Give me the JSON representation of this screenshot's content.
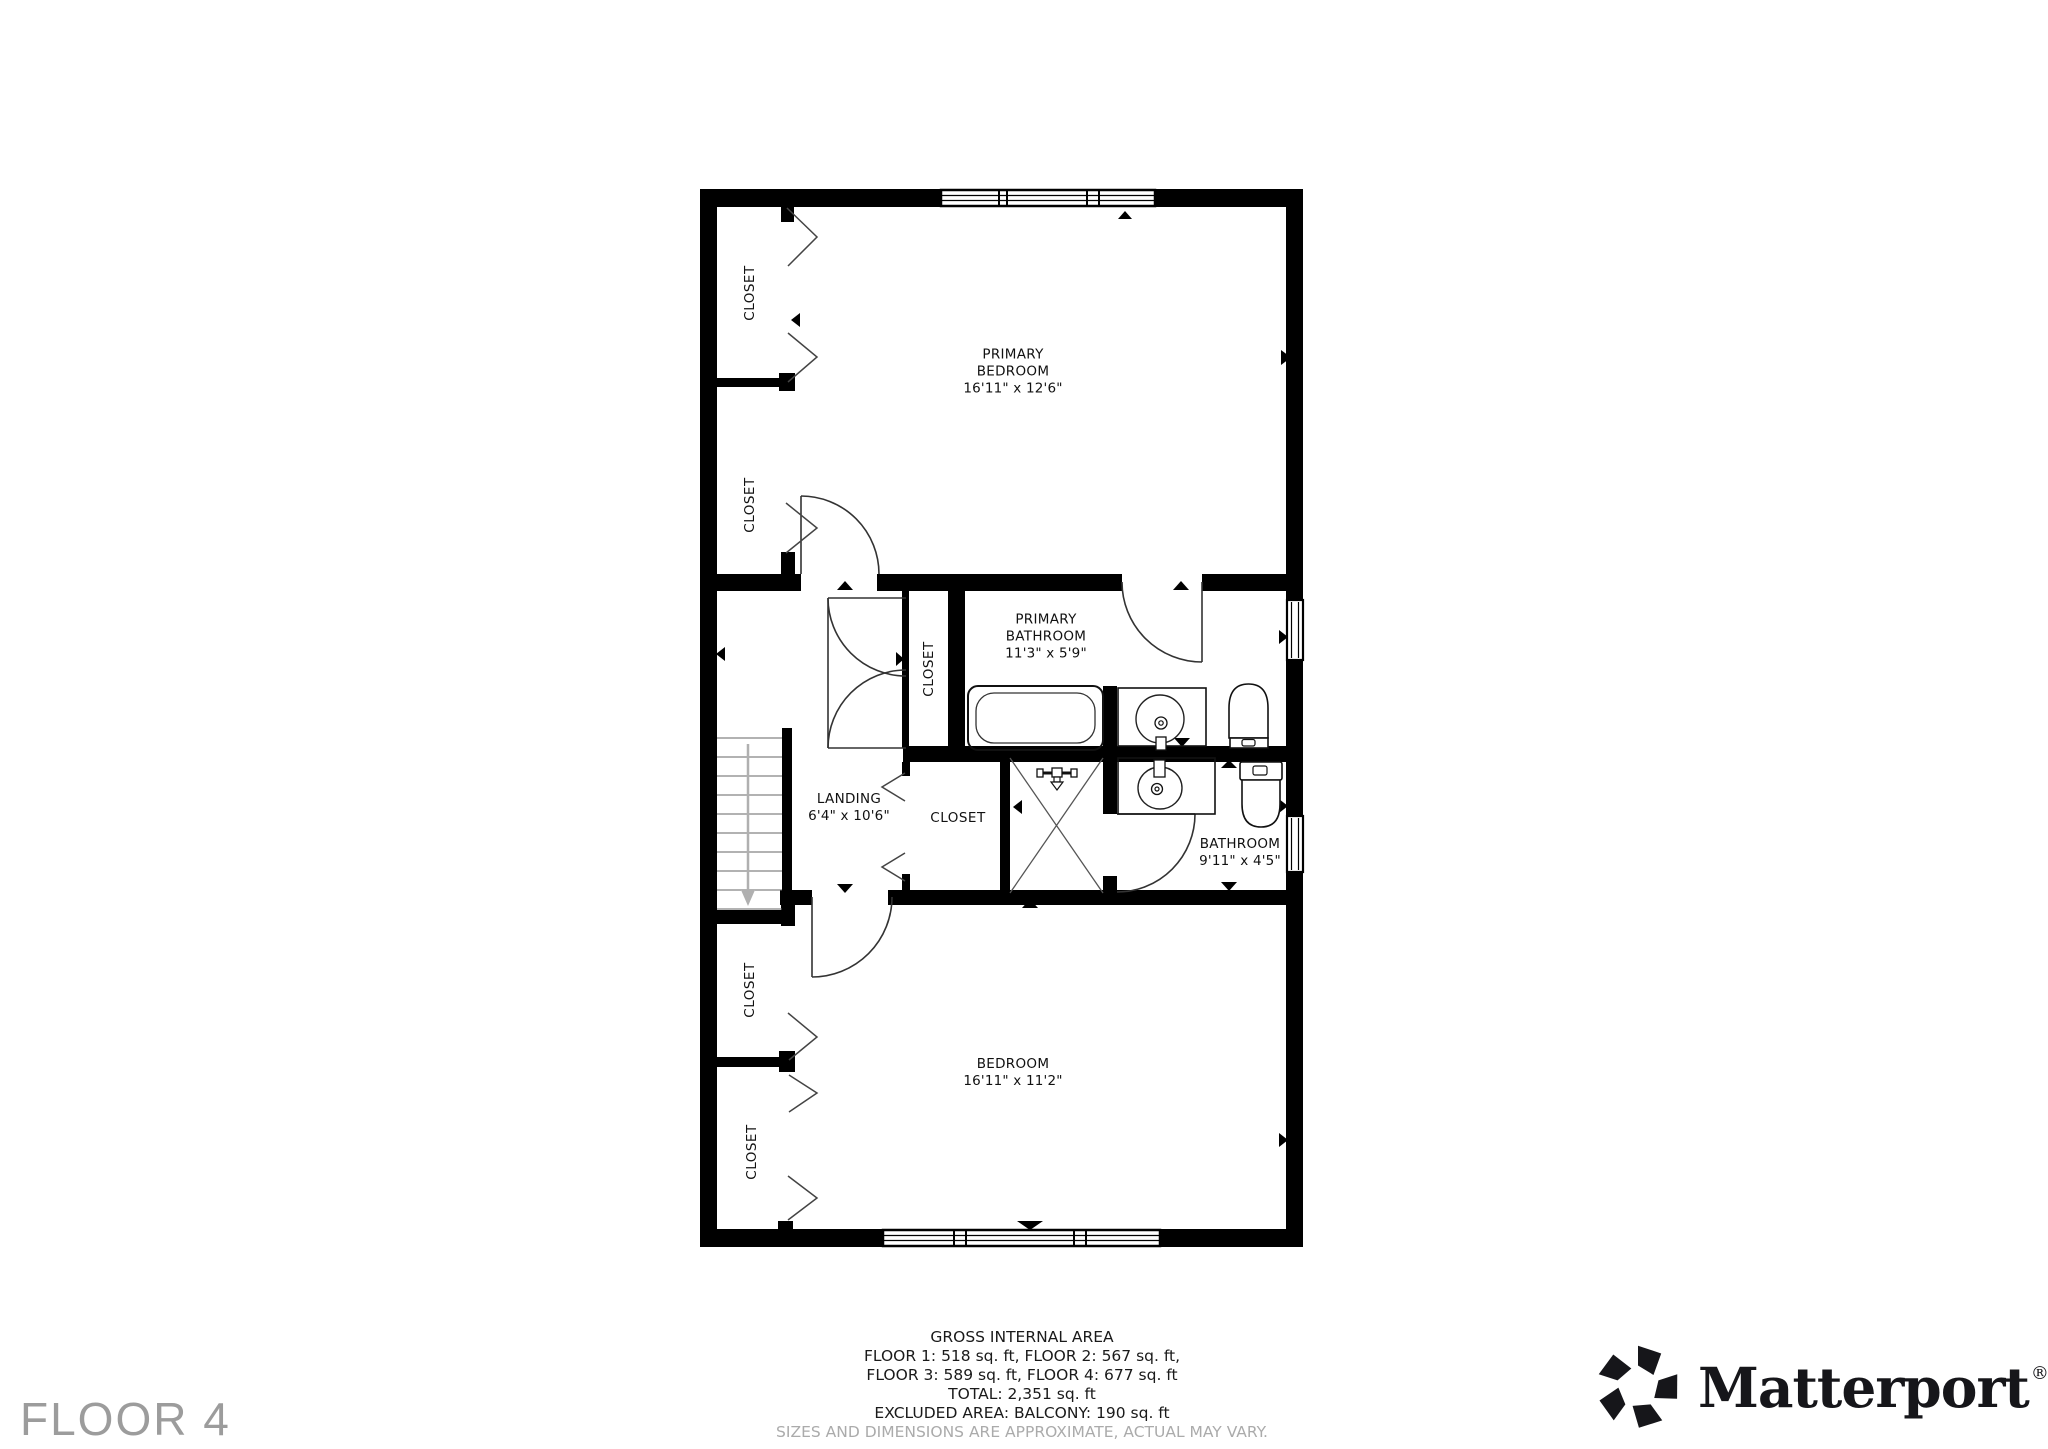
{
  "floor_label": "FLOOR 4",
  "closet_label": "CLOSET",
  "rooms": [
    {
      "line1": "PRIMARY",
      "line2": "BEDROOM",
      "dims": "16'11\" x 12'6\""
    },
    {
      "line1": "PRIMARY",
      "line2": "BATHROOM",
      "dims": "11'3\" x 5'9\""
    },
    {
      "line1": "LANDING",
      "dims": "6'4\" x 10'6\""
    },
    {
      "line1": "BATHROOM",
      "dims": "9'11\" x 4'5\""
    },
    {
      "line1": "BEDROOM",
      "dims": "16'11\" x 11'2\""
    }
  ],
  "area_summary": {
    "title": "GROSS INTERNAL AREA",
    "line_floors_1_2": "FLOOR 1: 518 sq. ft, FLOOR 2: 567 sq. ft,",
    "line_floors_3_4": "FLOOR 3: 589 sq. ft, FLOOR 4: 677 sq. ft",
    "total": "TOTAL: 2,351 sq. ft",
    "excluded": "EXCLUDED AREA: BALCONY: 190 sq. ft",
    "disclaimer": "SIZES AND DIMENSIONS ARE APPROXIMATE, ACTUAL MAY VARY."
  },
  "brand": {
    "name": "Matterport",
    "registered": "®"
  },
  "colors": {
    "wall": "#000000",
    "label": "#111111",
    "muted": "#ababab",
    "floor_label": "#9c9c9c",
    "brand": "#16161a"
  }
}
